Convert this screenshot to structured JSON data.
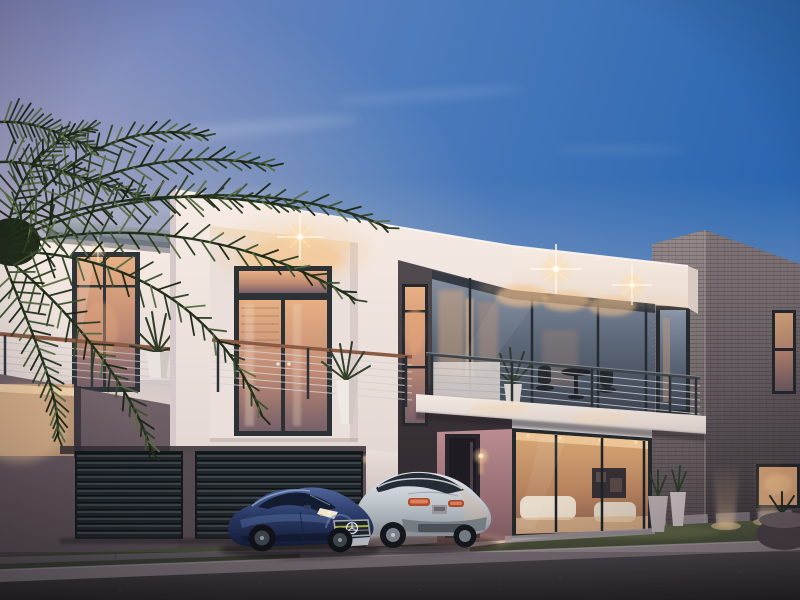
{
  "scene": {
    "type": "architectural-exterior-render",
    "time_of_day": "dusk",
    "subject": "modern two-storey luxury house with palm tree and two parked cars"
  },
  "colors": {
    "sky_lavender": "#8186bd",
    "sky_mid": "#4f7cbc",
    "sky_deep": "#2a66b0",
    "horizon_glow": "#f7e2d2",
    "wall_white": "#f7ece5",
    "fascia_white": "#f6ebe3",
    "plum_wall": "#75646c",
    "tower_dark": "#514a4f",
    "brick_light": "#94898a",
    "brick_shaded": "#80767a",
    "glass_warm": "#e8b083",
    "glass_cool": "#8894a6",
    "lounge_glow": "#d8a876",
    "light_warm": "#ffeccb",
    "railing_wood": "#8a5a44",
    "lawn": "#565c41",
    "driveway": "#837a80",
    "asphalt": "#5b5458",
    "car_blue": "#2c3c6a",
    "car_silver": "#e4e8ec",
    "palm_green": "#2c3d22"
  },
  "objects": {
    "sky": "dusk gradient sky with wispy clouds",
    "palm_tree": "dark palm fronds, left foreground",
    "left_wing": "white wing with grey canopy and cable balcony",
    "central_box": "white volume with french doors and downlight",
    "dark_tower": "charcoal feature wall with two lit windows",
    "right_balcony": "cantilevered balcony with table, chairs and plant",
    "brick_tower": "grey brick tower with narrow windows",
    "garage": "two dark slatted garage doors",
    "lounge": "warm-lit ground floor lounge behind glass",
    "entry": "recessed entry door with wall sconce",
    "uplights": "ground uplights washing brick wall",
    "car_blue": "dark blue sports coupe, star grille",
    "car_silver": "silver crossover SUV, rear view",
    "street": "asphalt street with concrete kerb and lawn"
  }
}
